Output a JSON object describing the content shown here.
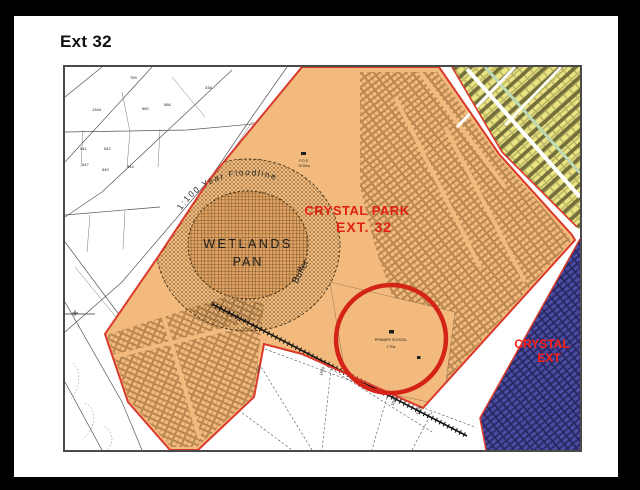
{
  "title": "Ext 32",
  "map": {
    "labels": {
      "region_title_line1": "CRYSTAL PARK",
      "region_title_line2": "EXT. 32",
      "wetlands_line1": "WETLANDS",
      "wetlands_line2": "PAN",
      "floodline": "1:100  Year  Floodline",
      "buffer": "Buffer",
      "pos": "P.O.S.",
      "pos_area": "10.90ha",
      "school_line1": "PRIMARY SCHOOL",
      "school_line2": "2.7Ha",
      "adjacent_line1": "CRYSTAL",
      "adjacent_line2": "EXT"
    },
    "plot_numbers": [
      {
        "v": "769",
        "x": 65,
        "y": 12,
        "r": 0
      },
      {
        "v": "338",
        "x": 140,
        "y": 22,
        "r": 0
      },
      {
        "v": "1344",
        "x": 27,
        "y": 44,
        "r": 0
      },
      {
        "v": "560",
        "x": 77,
        "y": 43,
        "r": 0
      },
      {
        "v": "586",
        "x": 99,
        "y": 39,
        "r": 0
      },
      {
        "v": "541",
        "x": 15,
        "y": 83,
        "r": 0
      },
      {
        "v": "542",
        "x": 39,
        "y": 83,
        "r": 0
      },
      {
        "v": "547",
        "x": 17,
        "y": 99,
        "r": 0
      },
      {
        "v": "540",
        "x": 37,
        "y": 104,
        "r": 0
      },
      {
        "v": "544",
        "x": 62,
        "y": 101,
        "r": 0
      },
      {
        "v": "1625",
        "x": 193,
        "y": 307,
        "r": -72
      },
      {
        "v": "1650",
        "x": 257,
        "y": 309,
        "r": -72
      },
      {
        "v": "1640",
        "x": 328,
        "y": 339,
        "r": -65
      },
      {
        "v": "1635",
        "x": 353,
        "y": 348,
        "r": -65
      }
    ],
    "colors": {
      "ext32_fill": "#F2BB7D",
      "boundary_red": "#D93A2B",
      "highlight_red": "#D42417",
      "label_red": "#E02013",
      "adjacent_label_red": "#FF1E12",
      "adjacent_blue": "#4B4BA2",
      "adjacent_yellow": "#EAE482",
      "olive_rows": "#5D5A31",
      "street_green": "#BCD9B4",
      "pan_fill": "#DFA263"
    }
  }
}
